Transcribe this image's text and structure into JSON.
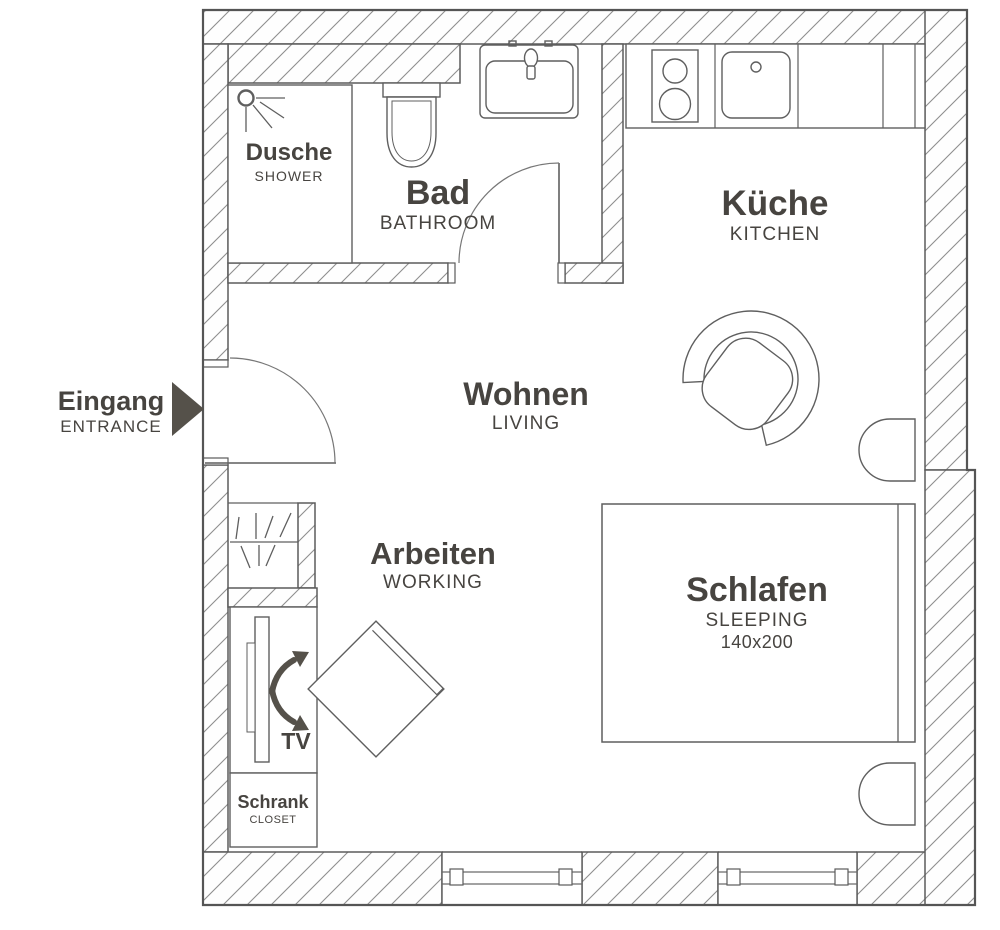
{
  "title": "Studio apartment floor plan",
  "colors": {
    "background": "#ffffff",
    "wall_line": "#5b5b5b",
    "hatch_line": "#8f8f8f",
    "text": "#474440",
    "arrow": "#55514a"
  },
  "rooms": [
    {
      "id": "dusche",
      "name": "Dusche",
      "name_en": "SHOWER"
    },
    {
      "id": "bad",
      "name": "Bad",
      "name_en": "BATHROOM"
    },
    {
      "id": "kueche",
      "name": "Küche",
      "name_en": "KITCHEN"
    },
    {
      "id": "wohnen",
      "name": "Wohnen",
      "name_en": "LIVING"
    },
    {
      "id": "arbeiten",
      "name": "Arbeiten",
      "name_en": "WORKING"
    },
    {
      "id": "schlafen",
      "name": "Schlafen",
      "name_en": "SLEEPING",
      "bed_size": "140x200"
    }
  ],
  "entrance": {
    "name": "Eingang",
    "name_en": "ENTRANCE"
  },
  "furniture": {
    "tv_label": "TV",
    "closet_name": "Schrank",
    "closet_name_en": "CLOSET"
  }
}
